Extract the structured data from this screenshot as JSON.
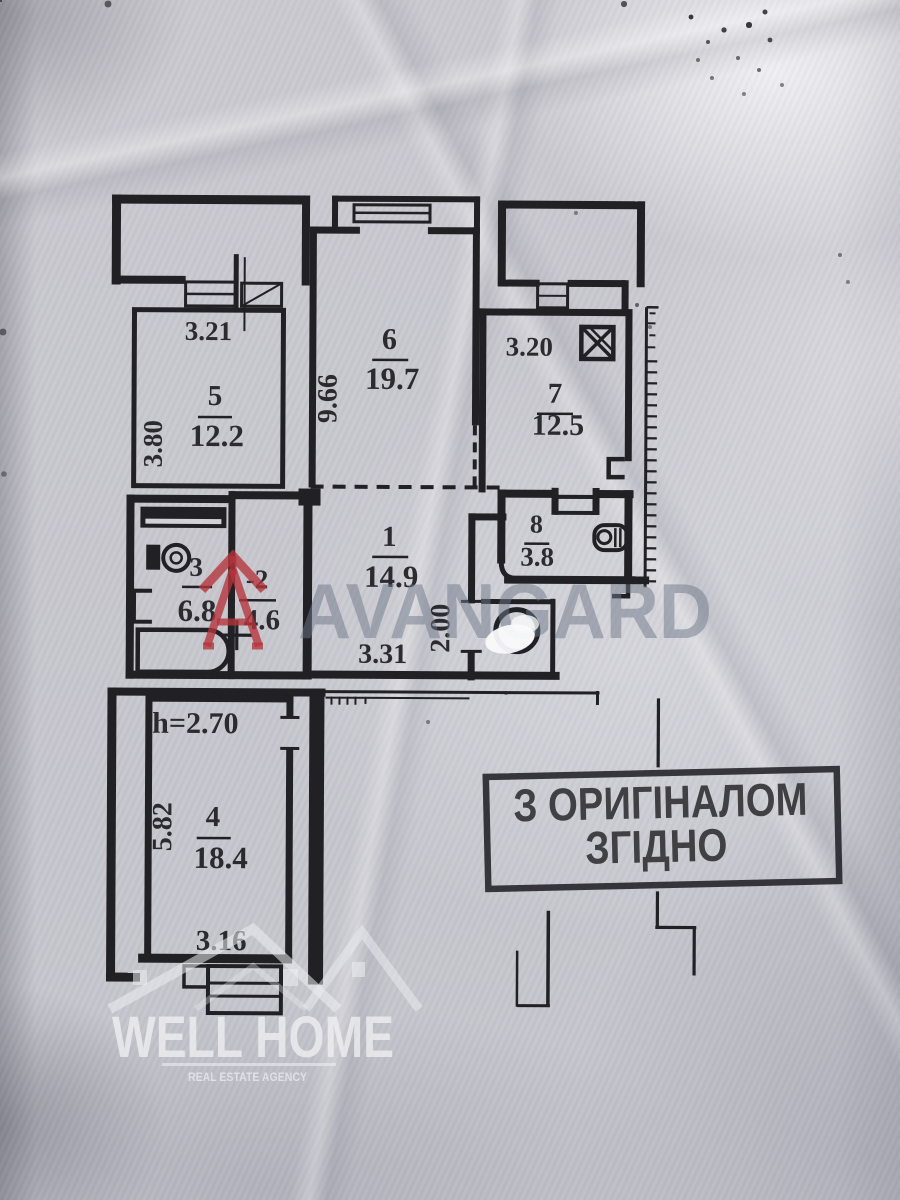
{
  "plan": {
    "rooms": [
      {
        "number": "5",
        "area": "12.2"
      },
      {
        "number": "6",
        "area": "19.7"
      },
      {
        "number": "7",
        "area": "12.5"
      },
      {
        "number": "8",
        "area": "3.8"
      },
      {
        "number": "1",
        "area": "14.9"
      },
      {
        "number": "-2",
        "area": "4.6"
      },
      {
        "number": "3",
        "area": "6.8"
      },
      {
        "number": "4",
        "area": "18.4"
      }
    ],
    "dimensions": {
      "room5_width": "3.21",
      "room5_depth": "3.80",
      "room6_depth": "9.66",
      "room7_width": "3.20",
      "room1_width": "3.31",
      "room1_depth": "2.00",
      "room4_ceiling_height": "h=2.70",
      "room4_depth": "5.82",
      "room4_width": "3.16"
    }
  },
  "stamp": {
    "line1": "З ОРИГІНАЛОМ",
    "line2": "ЗГІДНО"
  },
  "watermarks": {
    "avangard_text": "AVANGARD",
    "wellhome_title": "WELL HOME",
    "wellhome_subtitle": "REAL ESTATE AGENCY"
  },
  "colors": {
    "paper": "#cbcad1",
    "ink": "#202025",
    "stamp_ink": "#28282c",
    "avangard_red": "#b5333b",
    "watermark_gray": "#6d7787",
    "watermark_white": "#f3f3f7"
  }
}
